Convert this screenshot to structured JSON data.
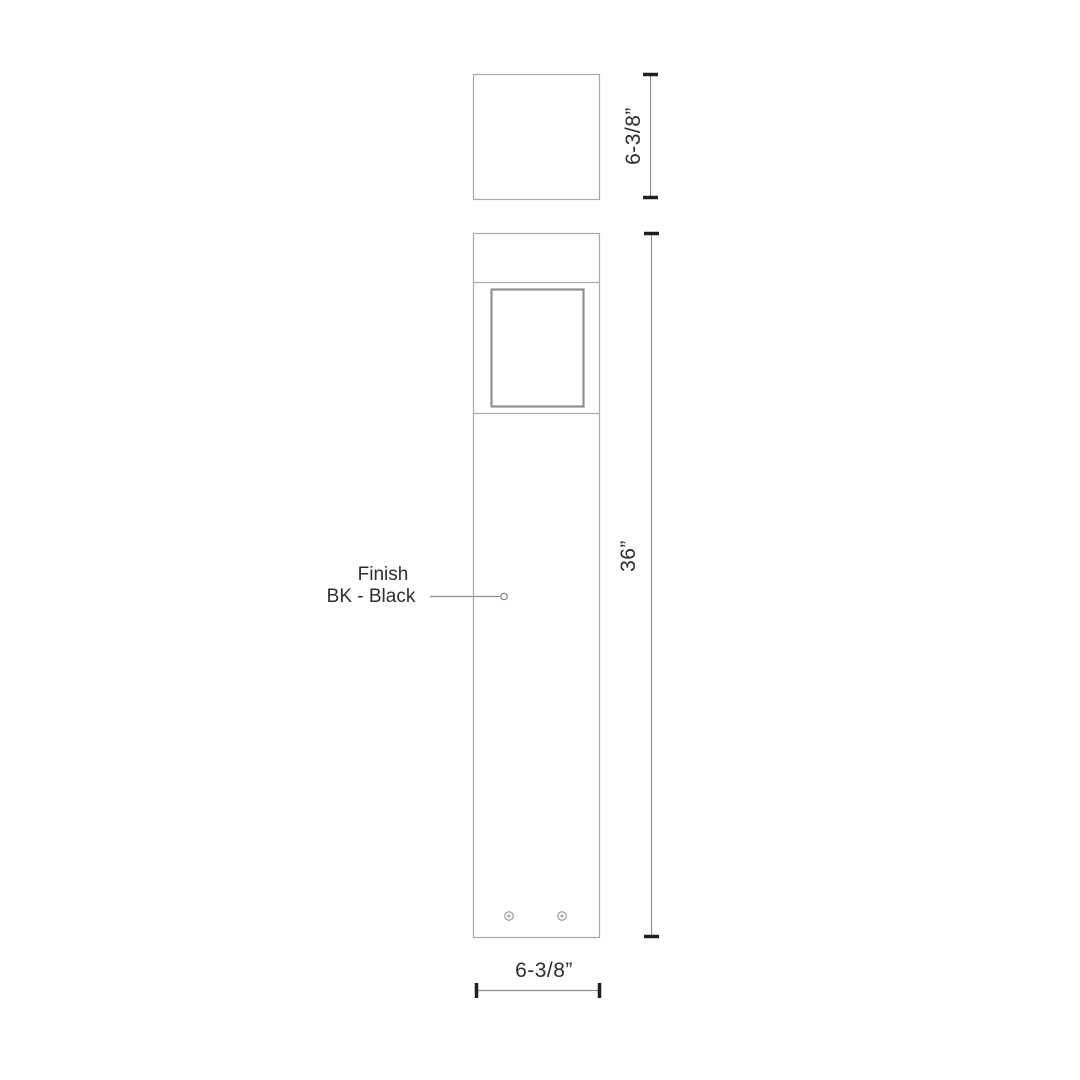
{
  "drawing": {
    "type": "bollard-light-dimension-drawing",
    "views": {
      "top_view": "plan view of square bollard head",
      "front_view": "elevation view of bollard with lens window and base screws"
    },
    "labels": {
      "finish": {
        "line1": "Finish",
        "line2": "BK - Black"
      }
    },
    "dimensions": {
      "head_size": "6-3/8”",
      "overall_height": "36”",
      "base_width": "6-3/8”"
    },
    "colors": {
      "body_outline": "#a8a8a8",
      "window_outline": "#8f8f8f",
      "dimension_line": "#8f8f8f",
      "dimension_cap": "#1f1f1f",
      "leader_line": "#8f8f8f",
      "text": "#2e2e2e",
      "background": "#ffffff"
    }
  }
}
